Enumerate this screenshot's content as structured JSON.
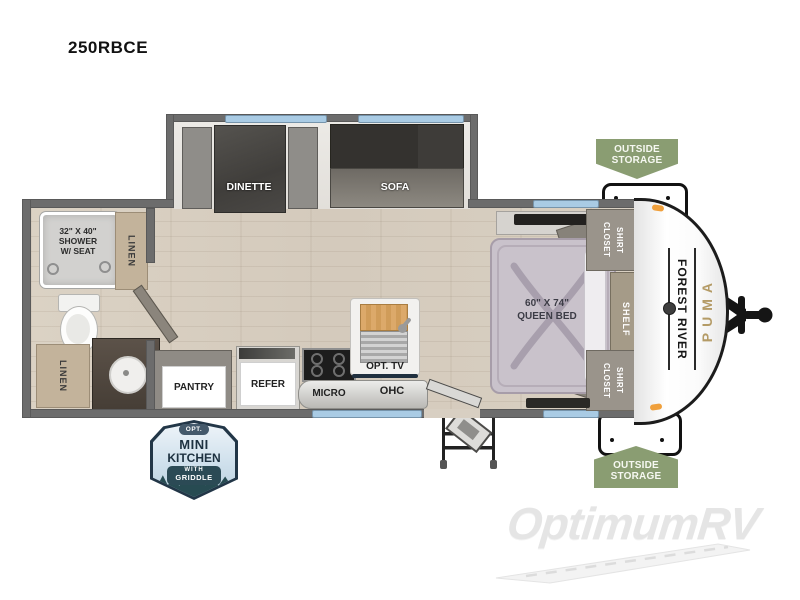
{
  "title": "250RBCE",
  "slideout": {
    "dinette": "DINETTE",
    "sofa": "SOFA"
  },
  "bathroom": {
    "shower": "32\" X 40\"\nSHOWER\nW/ SEAT",
    "linen_upper": "LINEN",
    "linen_lower": "LINEN"
  },
  "kitchen": {
    "pantry": "PANTRY",
    "refer": "REFER",
    "micro": "MICRO",
    "opt_tv": "OPT. TV",
    "ohc": "OHC"
  },
  "bedroom": {
    "bed": "60\" X 74\"\nQUEEN BED",
    "shirt_closet_upper": "SHIRT\nCLOSET",
    "shelf": "SHELF",
    "shirt_closet_lower": "SHIRT\nCLOSET"
  },
  "exterior": {
    "storage_upper": "OUTSIDE\nSTORAGE",
    "storage_lower": "OUTSIDE\nSTORAGE",
    "brand": "FOREST RIVER",
    "model": "PUMA"
  },
  "option_badge": {
    "opt": "OPT.",
    "mini": "MINI",
    "kitchen": "KITCHEN",
    "with": "WITH",
    "griddle": "GRIDDLE"
  },
  "watermark": "OptimumRV",
  "colors": {
    "wall": "#6c6c6c",
    "window_blue": "#a9cbe4",
    "storage_green": "#8a9d72",
    "floor_wood": "#d8cfc2",
    "badge_navy": "#223647",
    "puma_gold": "#b49b66",
    "marker_orange": "#f0a03c"
  }
}
